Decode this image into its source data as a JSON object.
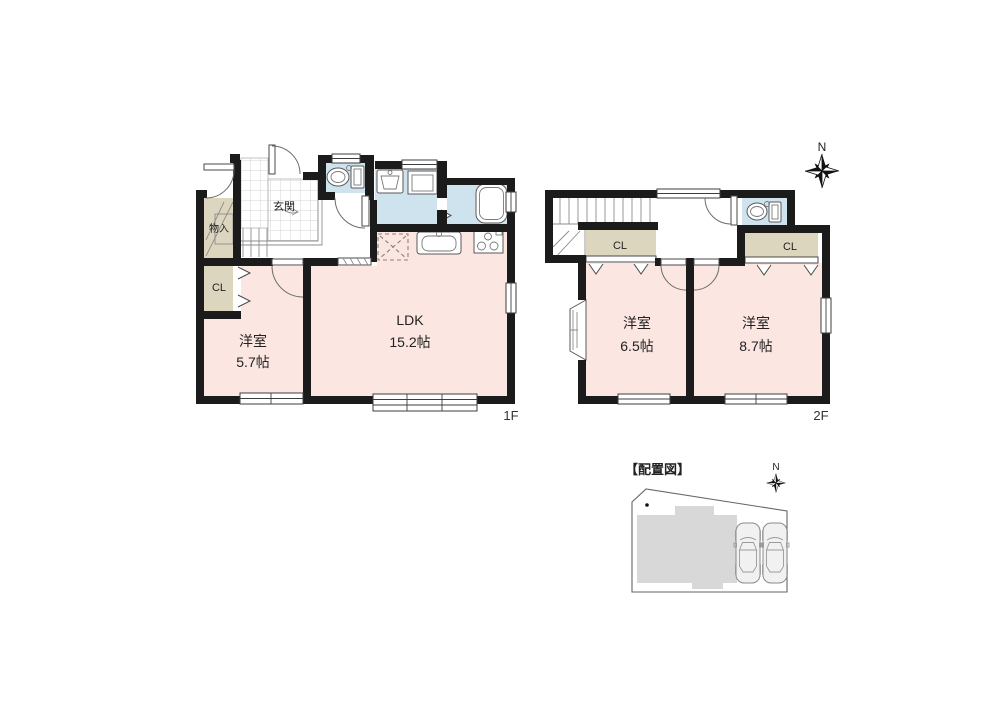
{
  "palette": {
    "wall": "#1b1b1b",
    "room_pink": "#fbe6e2",
    "wet_blue": "#cfe3ef",
    "closet_beige": "#ddd6bf",
    "site_gray": "#d8d8d8",
    "text": "#222222"
  },
  "floor1": {
    "floor_label": "1F",
    "entrance_label": "玄関",
    "storage_label": "物入",
    "closet_label": "CL",
    "bedroom": {
      "name": "洋室",
      "size": "5.7帖"
    },
    "ldk": {
      "name": "LDK",
      "size": "15.2帖"
    }
  },
  "floor2": {
    "floor_label": "2F",
    "compass_label": "N",
    "closet_left_label": "CL",
    "closet_right_label": "CL",
    "bedroom_left": {
      "name": "洋室",
      "size": "6.5帖"
    },
    "bedroom_right": {
      "name": "洋室",
      "size": "8.7帖"
    }
  },
  "site_plan": {
    "title": "【配置図】",
    "compass_label": "N"
  }
}
